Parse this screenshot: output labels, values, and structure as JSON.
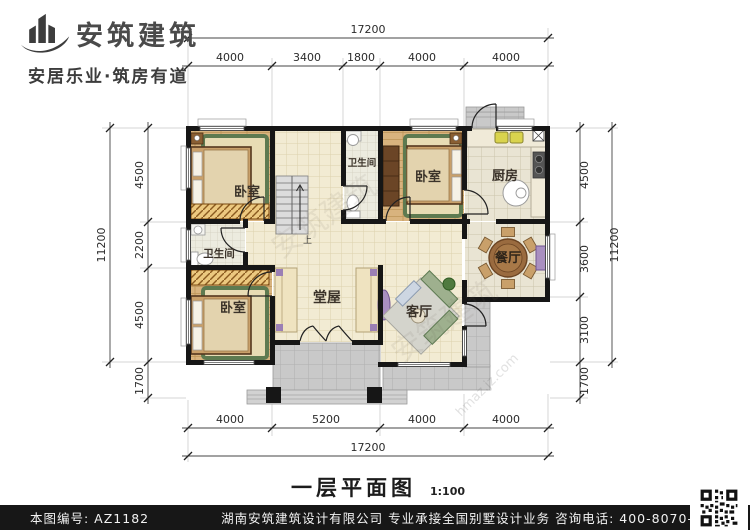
{
  "header": {
    "company_name": "安筑建筑",
    "tagline": "安居乐业·筑房有道"
  },
  "plan": {
    "rooms": {
      "bedroom_top_left": "卧室",
      "bathroom_top": "卫生间",
      "bedroom_top_right": "卧室",
      "kitchen": "厨房",
      "bathroom_left": "卫生间",
      "bedroom_bottom_left": "卧室",
      "hall": "堂屋",
      "living_room": "客厅",
      "dining_room": "餐厅"
    },
    "stairs_up_label": "上",
    "watermark": "安筑建筑",
    "watermark2": "hmaz.jz.com"
  },
  "dimensions": {
    "top": {
      "total": "17200",
      "segments": [
        "4000",
        "3400",
        "1800",
        "4000",
        "4000"
      ]
    },
    "bottom": {
      "total": "17200",
      "segments": [
        "4000",
        "5200",
        "4000",
        "4000"
      ]
    },
    "left": {
      "total": "11200",
      "segments": [
        "4500",
        "2200",
        "4500",
        "1700"
      ]
    },
    "right": {
      "total": "11200",
      "segments": [
        "4500",
        "3600",
        "3100",
        "1700"
      ]
    }
  },
  "title": {
    "text": "一层平面图",
    "scale": "1:100"
  },
  "footer": {
    "drawing_no": "本图编号: AZ1182",
    "company_line": "湖南安筑建筑设计有限公司  专业承接全国别墅设计业务  咨询电话: 400-8070-511",
    "web_char": "网"
  },
  "colors": {
    "wall": "#161616",
    "floor_tile": "#f2ebd3",
    "wood_floor": "#d8b37e",
    "patio": "#c9c9c9",
    "rug_green": "#5e7a50",
    "footer_bg": "#171717"
  }
}
